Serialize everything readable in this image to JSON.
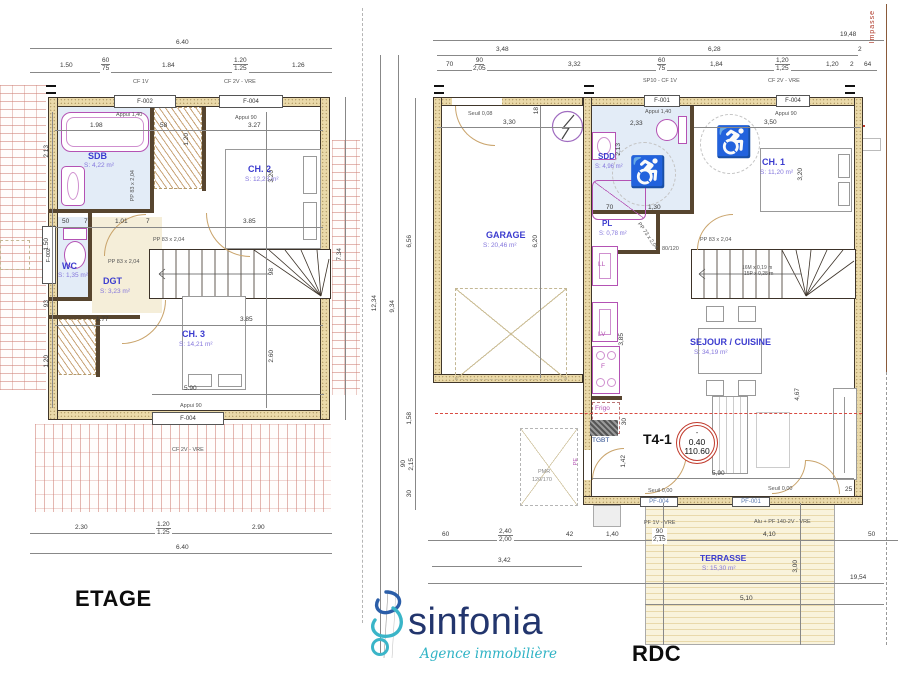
{
  "etage": {
    "title": "ETAGE",
    "rooms": {
      "sdb": {
        "name": "SDB",
        "area": "S: 4,22 m²"
      },
      "ch2": {
        "name": "CH. 2",
        "area": "S: 12,28 m²"
      },
      "wc": {
        "name": "WC",
        "area": "S: 1,35 m²"
      },
      "dgt": {
        "name": "DGT",
        "area": "S: 3,23 m²"
      },
      "ch3": {
        "name": "CH. 3",
        "area": "S: 14,21 m²"
      }
    },
    "windows": {
      "top_left": "F-002",
      "top_right": "F-004",
      "side_left": "F-002",
      "bottom": "F-004"
    },
    "notes": {
      "cf1v": "CF 1V",
      "cf2v_top": "CF 2V - VRE",
      "appui140": "Appui 1,40",
      "appui90_top": "Appui 90",
      "pp83": "PP 83 x 2,04",
      "appui90_bottom": "Appui 90",
      "cf2v_bottom": "CF 2V - VRE"
    },
    "dims": {
      "total_top": "6.40",
      "t1": "1.50",
      "t2a": "60",
      "t2b": "75",
      "t3": "1.84",
      "t4a": "1.20",
      "t4b": "1.25",
      "t5": "1.26",
      "d198": "1.98",
      "d58": "58",
      "d327": "3.27",
      "d213": "2.13",
      "d120a": "1.20",
      "d320": "3.20",
      "d50": "50",
      "d7": "7",
      "d101": "1.01",
      "d385a": "3.85",
      "d150": "1.50",
      "d93": "93",
      "d177": "1.77",
      "d385b": "3.85",
      "d98": "98",
      "d260": "2.60",
      "d120b": "1.20",
      "d590": "5.90",
      "d734": "7.34",
      "b1": "2.30",
      "b2a": "1.20",
      "b2b": "1.25",
      "b3": "2.90",
      "total_bottom": "6.40"
    }
  },
  "rdc": {
    "title": "RDC",
    "rooms": {
      "garage": {
        "name": "GARAGE",
        "area": "S: 20,46 m²"
      },
      "sdd": {
        "name": "SDD",
        "area": "S: 4,96 m²"
      },
      "pl": {
        "name": "PL",
        "area": "S: 0,78 m²"
      },
      "ch1": {
        "name": "CH. 1",
        "area": "S: 11,20 m²"
      },
      "sejour": {
        "name": "SEJOUR / CUISINE",
        "area": "S: 34,19 m²"
      },
      "terrasse": {
        "name": "TERRASSE",
        "area": "S: 15,30 m²"
      }
    },
    "windows": {
      "f001": "F-001",
      "f004": "F-004",
      "pf001": "PF-001",
      "pf004": "PF-004"
    },
    "labels": {
      "ll": "LL",
      "lv": "LV",
      "f": "F",
      "frigo": "Frigo",
      "tgbt": "TGBT",
      "pe": "PE",
      "pmr1": "PMR",
      "pmr2": "120/170",
      "t4": "T4-1",
      "lvl_sign": "-",
      "lvl_a": "0.40",
      "lvl_b": "110.60",
      "impasse": "Impasse"
    },
    "notes": {
      "seuil008": "Seuil 0,08",
      "seuil000a": "Seuil 0,00",
      "seuil000b": "Seuil 0,00",
      "sp10": "SP10 - CF 1V",
      "cf2v": "CF 2V - VRE",
      "appui140": "Appui 1,40",
      "appui90": "Appui 90",
      "pf1v": "PF 1V - VRE",
      "alu": "Alu + PF 140-2V - VRE",
      "pp83": "PP 83 x 2,04",
      "pp73": "PP 73 x 2,04",
      "shower": "80/120",
      "stair1": "16M x 0,19 m",
      "stair2": "15P x 0,28 m"
    },
    "dims": {
      "total_top": "19,48",
      "g1": "3,48",
      "g2": "6,28",
      "g3": "2",
      "s1": "70",
      "s2a": "90",
      "s2b": "2,05",
      "s3": "3,32",
      "s4a": "60",
      "s4b": "75",
      "s5": "1,84",
      "s6a": "1,20",
      "s6b": "1,25",
      "s7": "1,20",
      "s8": "2",
      "s9": "64",
      "d330": "3,30",
      "d18": "18",
      "d620": "6,20",
      "d233": "2,33",
      "d213": "2,13",
      "d70": "70",
      "d130": "1,30",
      "d350": "3,50",
      "d320": "3,20",
      "d385": "3,85",
      "d467": "4,67",
      "d590": "5,90",
      "d142": "1,42",
      "d30": "30",
      "d25": "25",
      "v1": "12,34",
      "v2": "9,34",
      "v3": "6,56",
      "v4": "1,58",
      "v5a": "90",
      "v5b": "2,15",
      "v6": "30",
      "b1": "60",
      "b2a": "2,40",
      "b2b": "2,00",
      "b3": "42",
      "b4": "1,40",
      "b5a": "90",
      "b5b": "2,15",
      "b6": "4,10",
      "b7": "50",
      "b342": "3,42",
      "b1954": "19,54",
      "b510": "5,10",
      "b300": "3,00"
    }
  },
  "logo": {
    "name": "sinfonia",
    "tagline": "Agence immobilière"
  }
}
